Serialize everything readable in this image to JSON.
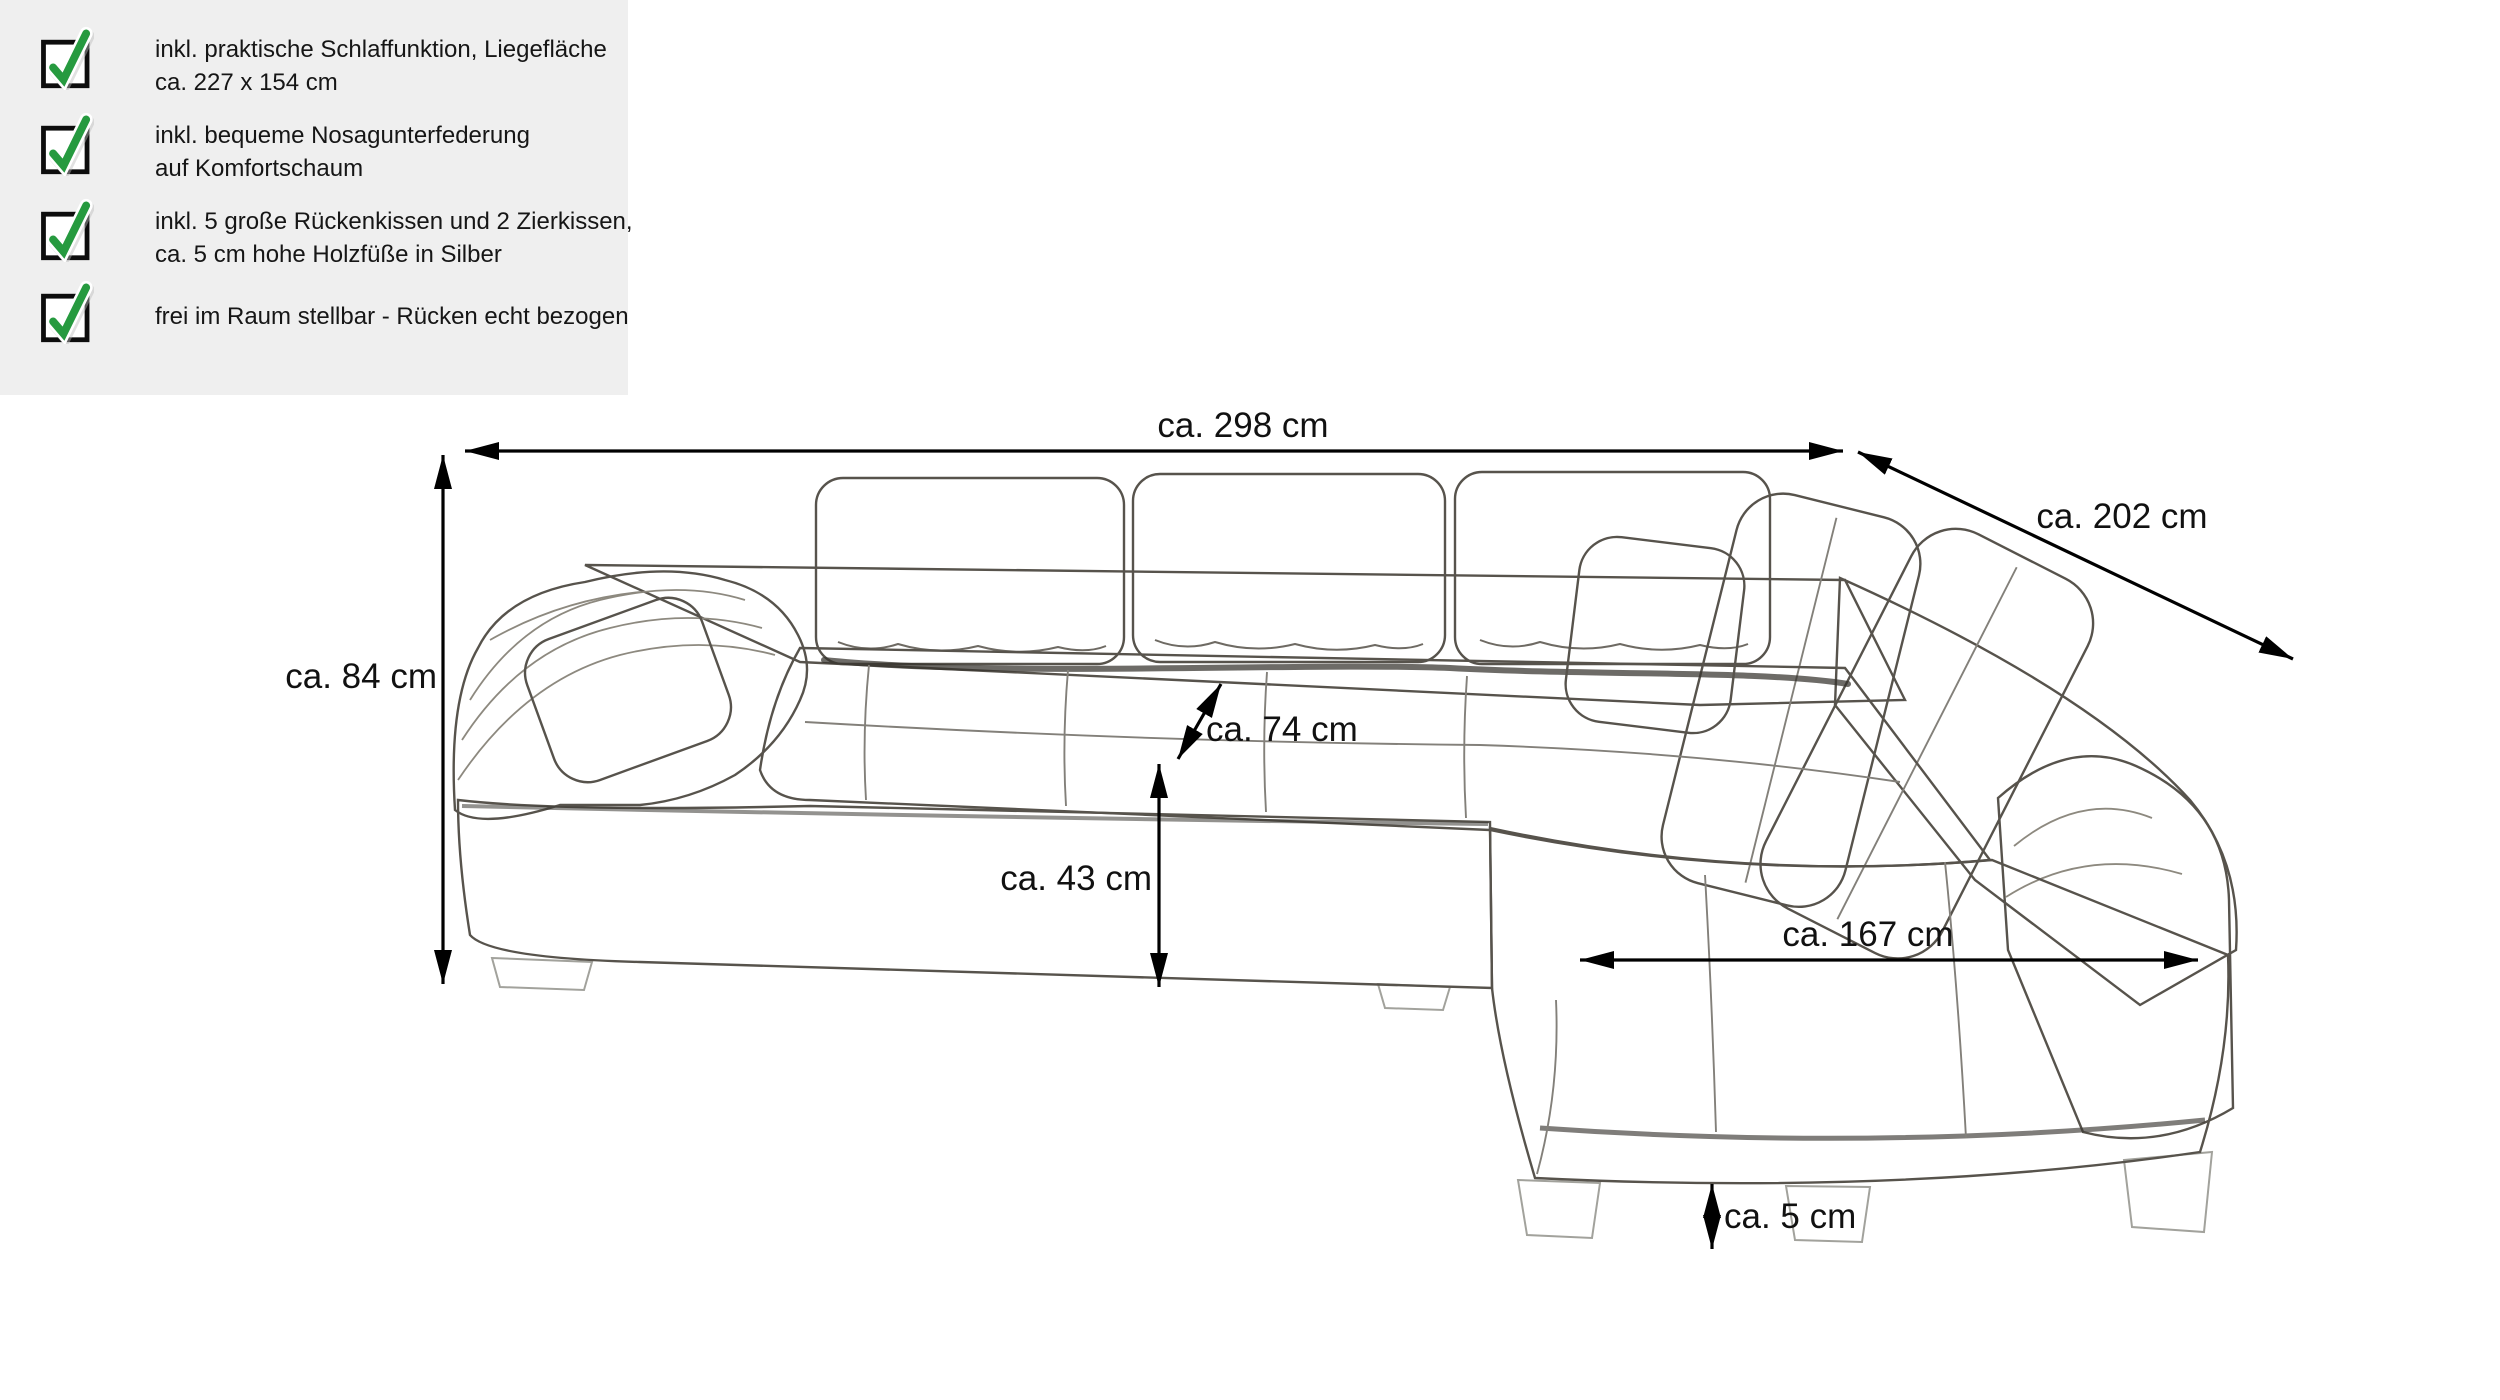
{
  "features": {
    "panel_bg": "#efefef",
    "check_color": "#269a3f",
    "box_color": "#0d0d0d",
    "items": [
      {
        "icon": "checkbox-checked-icon",
        "line1": "inkl. praktische Schlaffunktion, Liegefläche",
        "line2": "ca. 227 x 154 cm"
      },
      {
        "icon": "checkbox-checked-icon",
        "line1": "inkl. bequeme Nosagunterfederung",
        "line2": "auf Komfortschaum"
      },
      {
        "icon": "checkbox-checked-icon",
        "line1": "inkl. 5 große Rückenkissen und 2 Zierkissen,",
        "line2": "ca. 5 cm hohe Holzfüße in Silber"
      },
      {
        "icon": "checkbox-checked-icon",
        "line1": "frei im Raum stellbar - Rücken echt bezogen",
        "line2": ""
      }
    ]
  },
  "diagram": {
    "subject": "corner sofa with sleep function - dimension line drawing",
    "line_color": "#000000",
    "dimensions": {
      "total_width": "ca. 298 cm",
      "depth_right": "ca. 202 cm",
      "back_height": "ca. 84 cm",
      "backrest_height": "ca. 74 cm",
      "seat_height": "ca. 43 cm",
      "chaise_length": "ca. 167 cm",
      "feet_height": "ca. 5 cm"
    }
  }
}
